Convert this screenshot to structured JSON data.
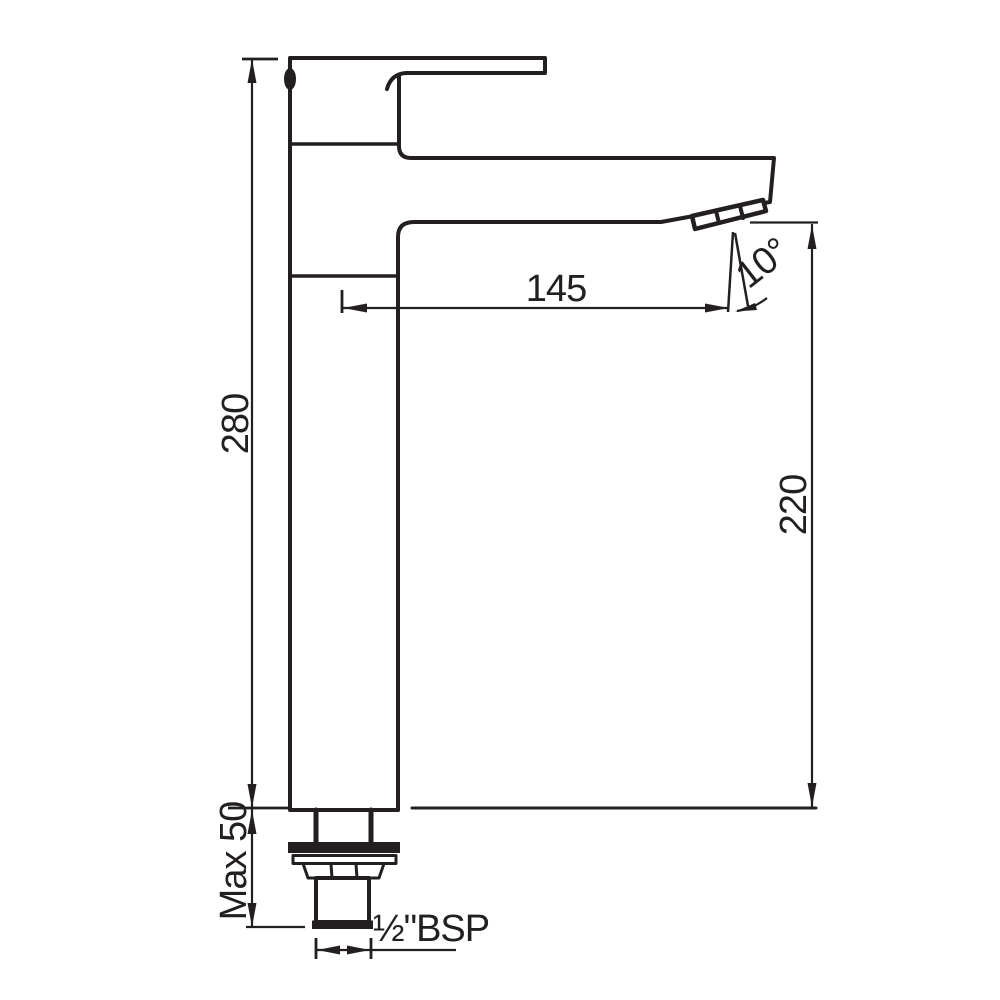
{
  "page": {
    "background": "#ffffff",
    "line_color": "#231f20"
  },
  "dimensions": {
    "overall_height": "280",
    "outlet_height": "220",
    "spout_reach": "145",
    "outlet_angle": "10°",
    "max_mounting_thickness": "Max 50",
    "inlet_thread": "½\"BSP"
  }
}
